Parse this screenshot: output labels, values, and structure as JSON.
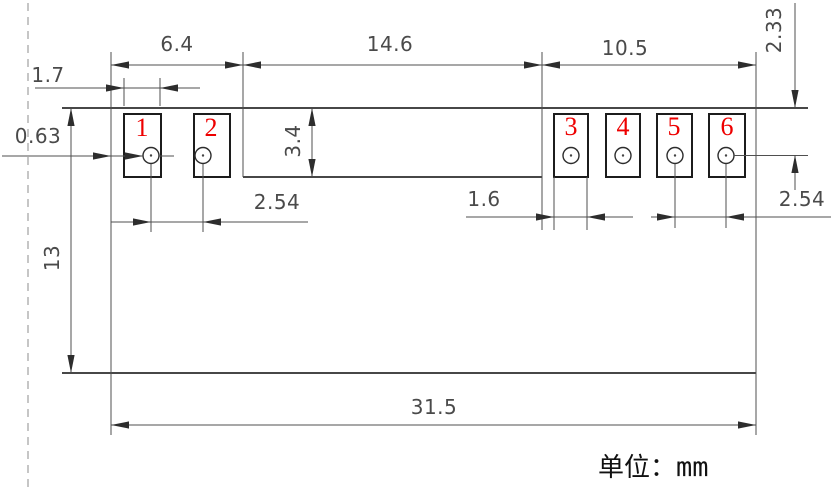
{
  "drawing": {
    "title_hint": "component footprint dimension drawing",
    "unit_note": {
      "label": "单位：",
      "value": "mm"
    },
    "pins": [
      "1",
      "2",
      "3",
      "4",
      "5",
      "6"
    ],
    "dims": {
      "left_group_width": "6.4",
      "middle_width": "14.6",
      "right_group_width": "10.5",
      "pad1_width": "1.7",
      "edge_offset": "0.63",
      "recess_depth": "3.4",
      "body_height": "13",
      "hole_row_offset": "2.33",
      "pitch_left": "2.54",
      "pad_right_width": "1.6",
      "pitch_right": "2.54",
      "body_width": "31.5"
    },
    "colors": {
      "pin_number": "#ee0000",
      "body_line": "#2d2d2d",
      "dim_line": "#4f4f4f",
      "dim_text": "#4a4a4a",
      "dashed_centerline": "#adadad"
    }
  }
}
